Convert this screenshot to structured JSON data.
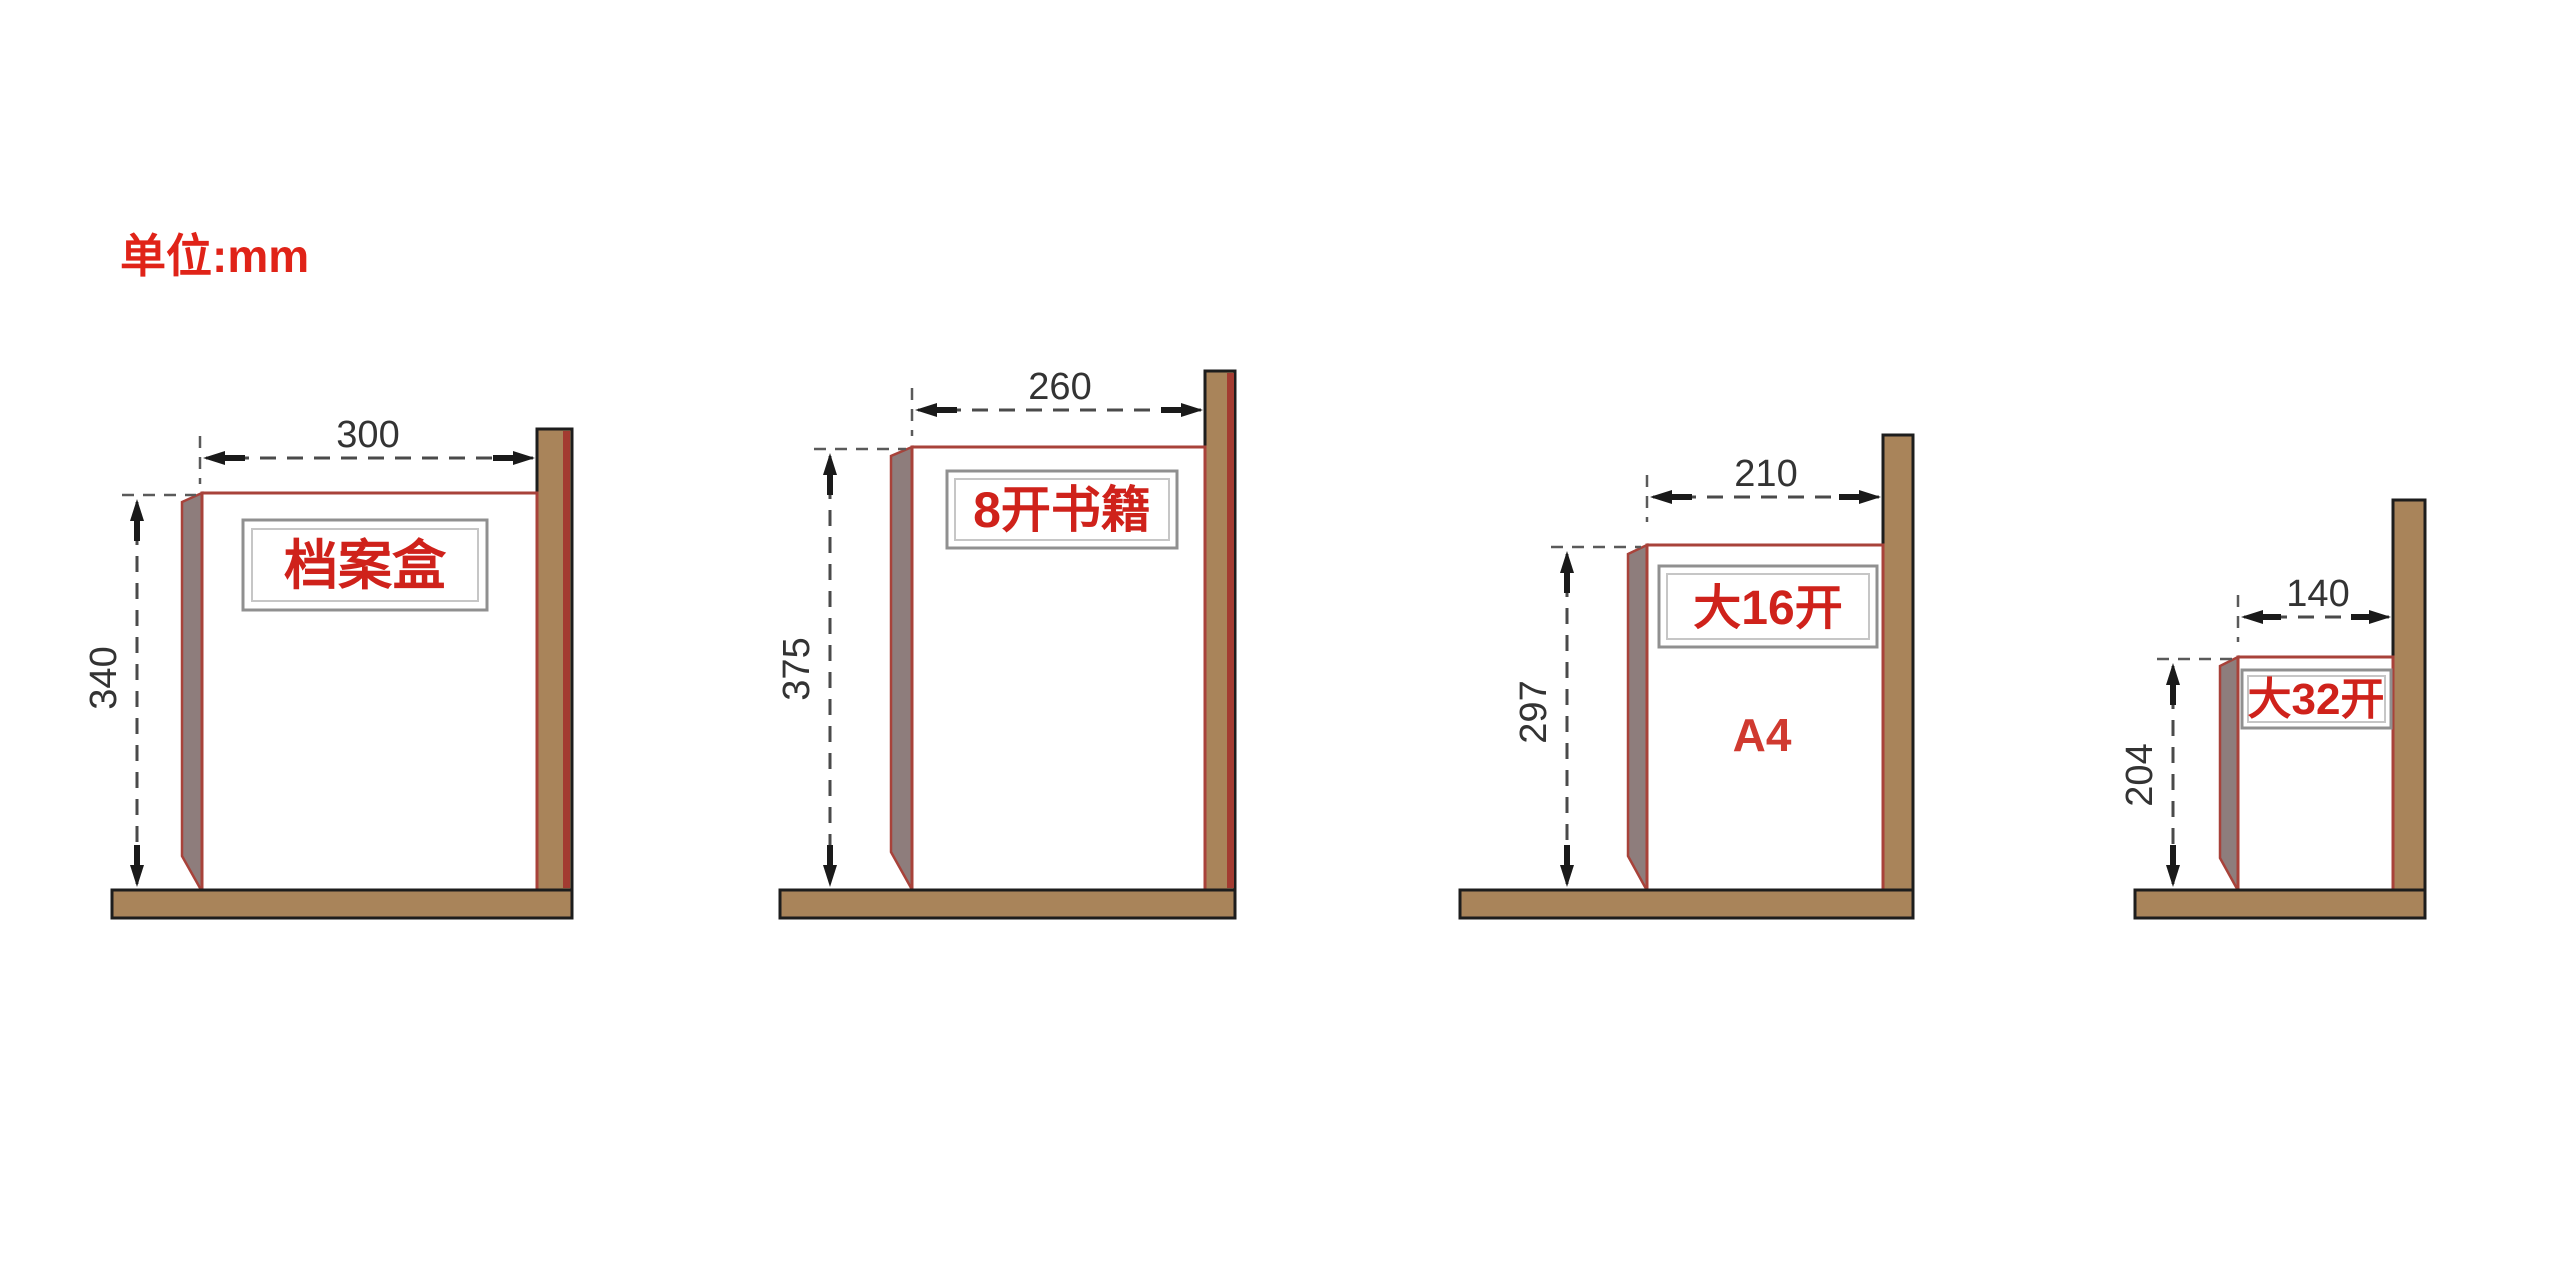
{
  "unit_label": "单位:mm",
  "colors": {
    "wood": "#a9845a",
    "wood_outline": "#1d1d1d",
    "post_shadow_red": "#a33b31",
    "book_outline_red": "#a8423a",
    "spine_gray": "#8e7d7c",
    "plate_border_outer": "#909090",
    "plate_border_inner": "#c6c6c6",
    "label_red": "#cf221b",
    "unit_red": "#e02318",
    "dimension_gray": "#4a4a4a"
  },
  "diagrams": [
    {
      "id": "archive-box",
      "label": "档案盒",
      "sublabel": "",
      "width_mm": "300",
      "height_mm": "340"
    },
    {
      "id": "book-8kai",
      "label": "8开书籍",
      "sublabel": "",
      "width_mm": "260",
      "height_mm": "375"
    },
    {
      "id": "book-16kai",
      "label": "大16开",
      "sublabel": "A4",
      "width_mm": "210",
      "height_mm": "297"
    },
    {
      "id": "book-32kai",
      "label": "大32开",
      "sublabel": "",
      "width_mm": "140",
      "height_mm": "204"
    }
  ]
}
